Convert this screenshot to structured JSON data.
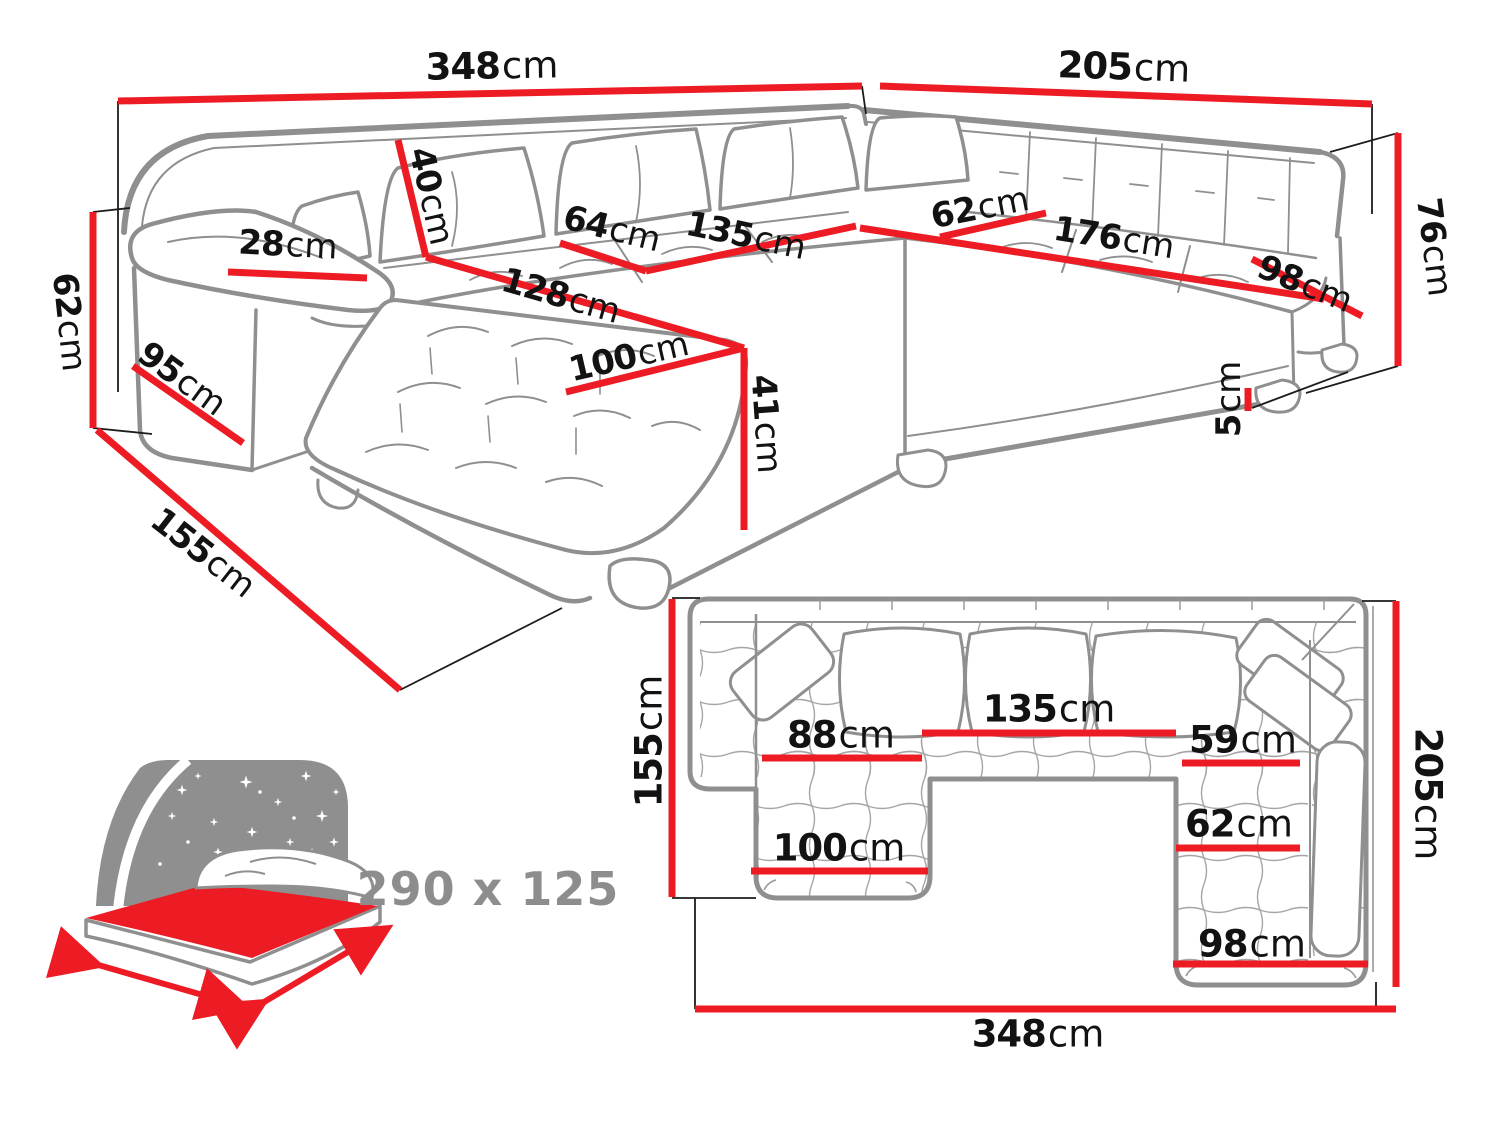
{
  "colors": {
    "dimension_red": "#ED1C24",
    "outline_gray": "#8f8f8f",
    "text_black": "#121212",
    "muted_gray": "#8d8d8d"
  },
  "perspective_view": {
    "back_width_left": {
      "value": "348",
      "unit": "cm"
    },
    "back_width_right": {
      "value": "205",
      "unit": "cm"
    },
    "back_height": {
      "value": "76",
      "unit": "cm"
    },
    "leg_height": {
      "value": "5",
      "unit": "cm"
    },
    "armrest_height": {
      "value": "62",
      "unit": "cm"
    },
    "armrest_side_depth": {
      "value": "95",
      "unit": "cm"
    },
    "chaise_total_depth": {
      "value": "155",
      "unit": "cm"
    },
    "armrest_top_width": {
      "value": "28",
      "unit": "cm"
    },
    "back_cushion_height": {
      "value": "40",
      "unit": "cm"
    },
    "seat_depth_left": {
      "value": "64",
      "unit": "cm"
    },
    "seat_width_left": {
      "value": "135",
      "unit": "cm"
    },
    "chaise_length": {
      "value": "128",
      "unit": "cm"
    },
    "chaise_width": {
      "value": "100",
      "unit": "cm"
    },
    "seat_height": {
      "value": "41",
      "unit": "cm"
    },
    "seat_depth_right": {
      "value": "62",
      "unit": "cm"
    },
    "seat_width_right": {
      "value": "176",
      "unit": "cm"
    },
    "right_arm_seat_width": {
      "value": "98",
      "unit": "cm"
    }
  },
  "sleeping_area": {
    "size": "290 x 125"
  },
  "top_view": {
    "left_depth": {
      "value": "155",
      "unit": "cm"
    },
    "chaise_seat_width": {
      "value": "88",
      "unit": "cm"
    },
    "middle_seat_width": {
      "value": "135",
      "unit": "cm"
    },
    "right_seat_depth": {
      "value": "59",
      "unit": "cm"
    },
    "right_inner_depth": {
      "value": "62",
      "unit": "cm"
    },
    "chaise_width": {
      "value": "100",
      "unit": "cm"
    },
    "right_seat_width": {
      "value": "98",
      "unit": "cm"
    },
    "right_side_depth": {
      "value": "205",
      "unit": "cm"
    },
    "total_width": {
      "value": "348",
      "unit": "cm"
    }
  }
}
